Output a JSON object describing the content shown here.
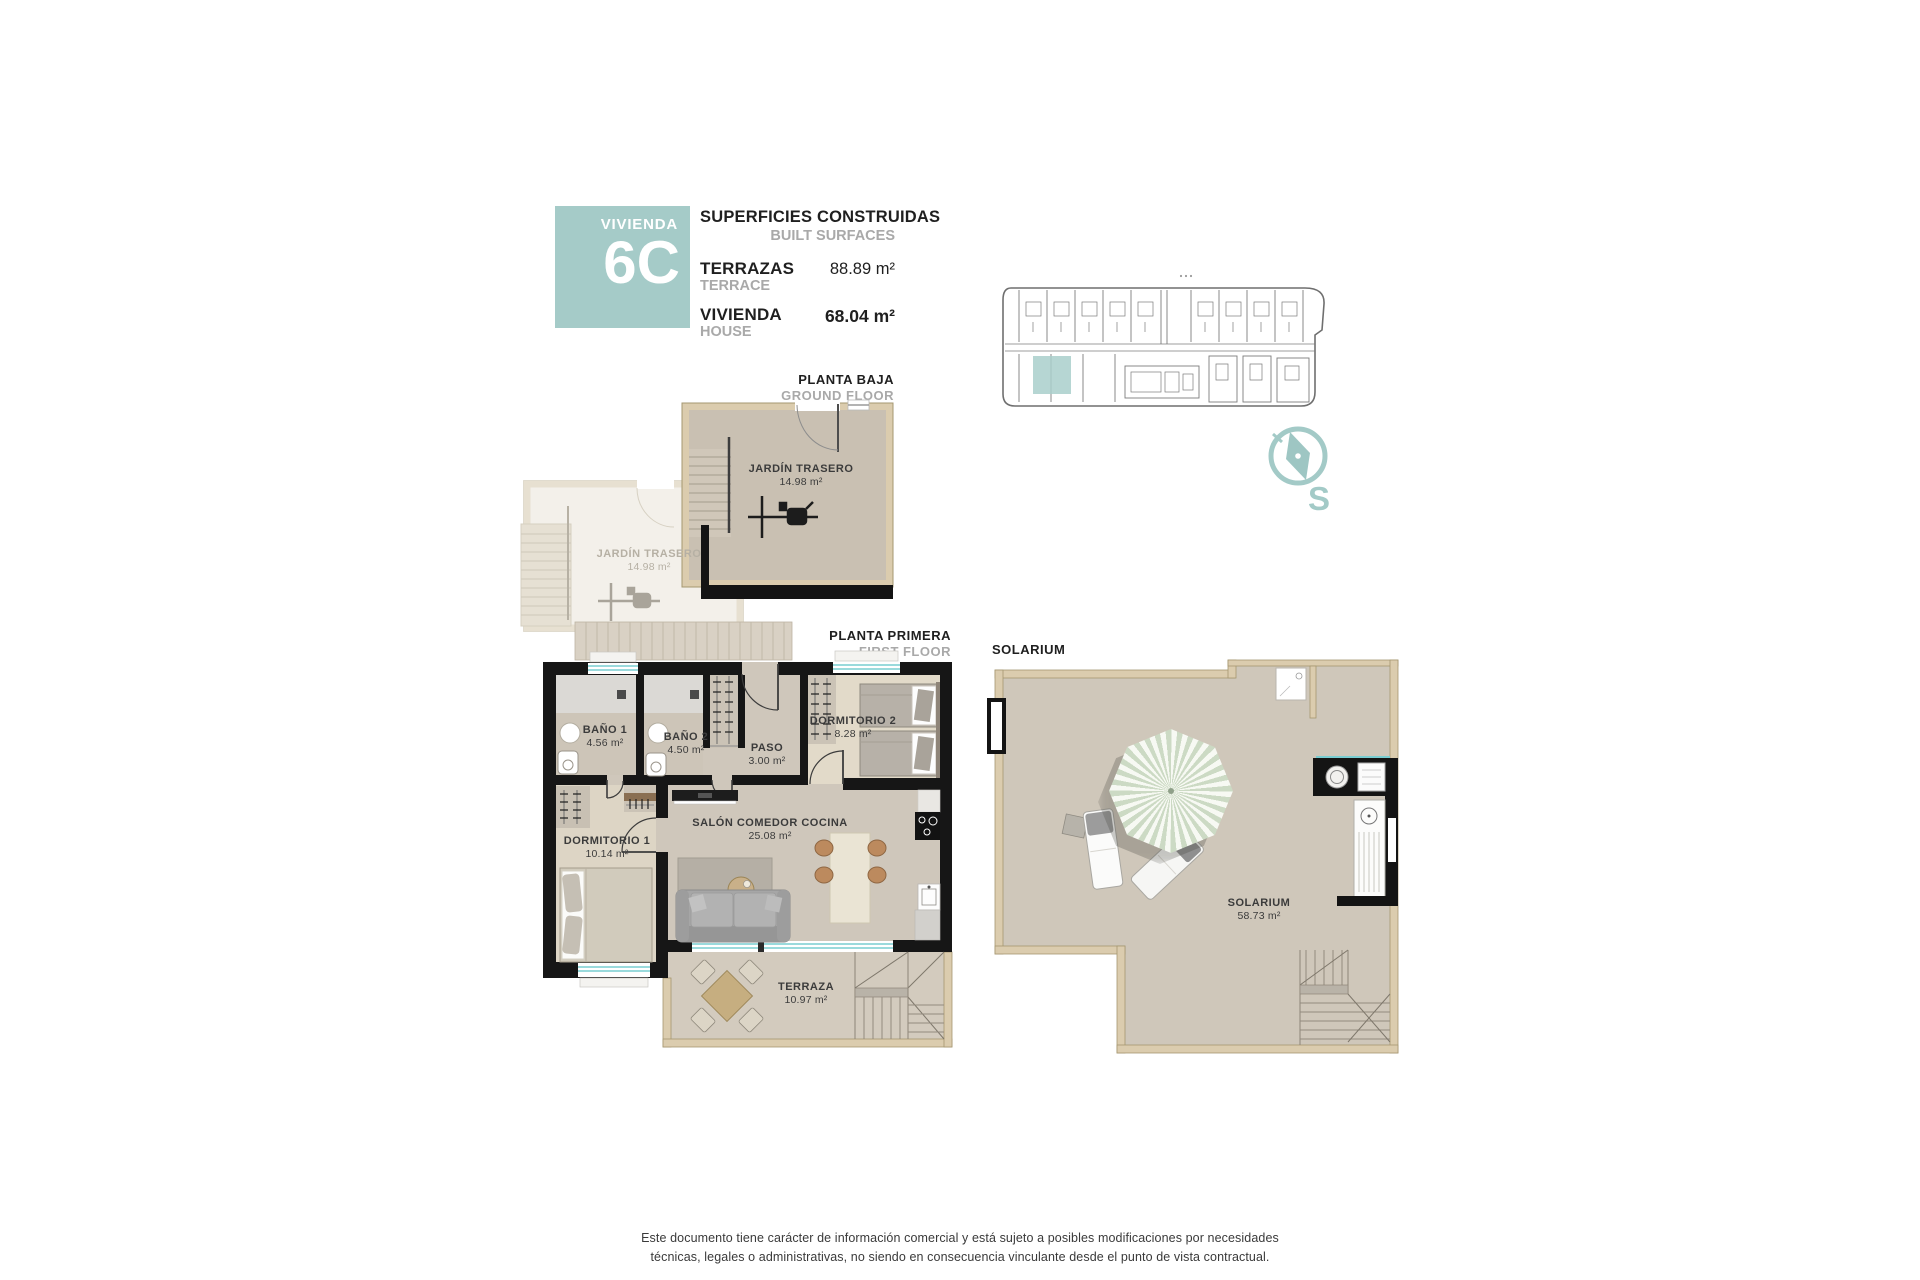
{
  "header": {
    "badge": {
      "label": "VIVIENDA",
      "unit": "6C"
    },
    "surfaces": {
      "title_es": "SUPERFICIES CONSTRUIDAS",
      "title_en": "BUILT SURFACES",
      "rows": [
        {
          "label_es": "TERRAZAS",
          "label_en": "TERRACE",
          "value": "88.89 m²"
        },
        {
          "label_es": "VIVIENDA",
          "label_en": "HOUSE",
          "value": "68.04 m²"
        }
      ]
    }
  },
  "compass": {
    "south_label": "S"
  },
  "floors": {
    "ground": {
      "title_es": "PLANTA BAJA",
      "title_en": "GROUND FLOOR",
      "rooms": [
        {
          "name": "JARDÍN TRASERO",
          "area": "14.98 m²"
        },
        {
          "name": "JARDÍN TRASERO",
          "area": "14.98 m²"
        }
      ]
    },
    "first": {
      "title_es": "PLANTA PRIMERA",
      "title_en": "FIRST FLOOR",
      "rooms": [
        {
          "name": "BAÑO 1",
          "area": "4.56 m²"
        },
        {
          "name": "BAÑO 2",
          "area": "4.50 m²"
        },
        {
          "name": "PASO",
          "area": "3.00 m²"
        },
        {
          "name": "DORMITORIO 2",
          "area": "8.28 m²"
        },
        {
          "name": "DORMITORIO 1",
          "area": "10.14 m²"
        },
        {
          "name": "SALÓN COMEDOR COCINA",
          "area": "25.08 m²"
        },
        {
          "name": "TERRAZA",
          "area": "10.97 m²"
        }
      ]
    },
    "solarium": {
      "title": "SOLARIUM",
      "rooms": [
        {
          "name": "SOLARIUM",
          "area": "58.73 m²"
        }
      ]
    }
  },
  "footer": {
    "line1": "Este documento tiene carácter de información comercial y está sujeto a posibles modificaciones por necesidades",
    "line2": "técnicas, legales o administrativas, no siendo en consecuencia vinculante desde el punto de vista contractual."
  },
  "colors": {
    "accent_teal": "#a5cbc8",
    "wall_black": "#161616",
    "wall_tan": "#dbccae",
    "window_teal": "#79cdd1",
    "muted_text": "#a9a9a9"
  }
}
